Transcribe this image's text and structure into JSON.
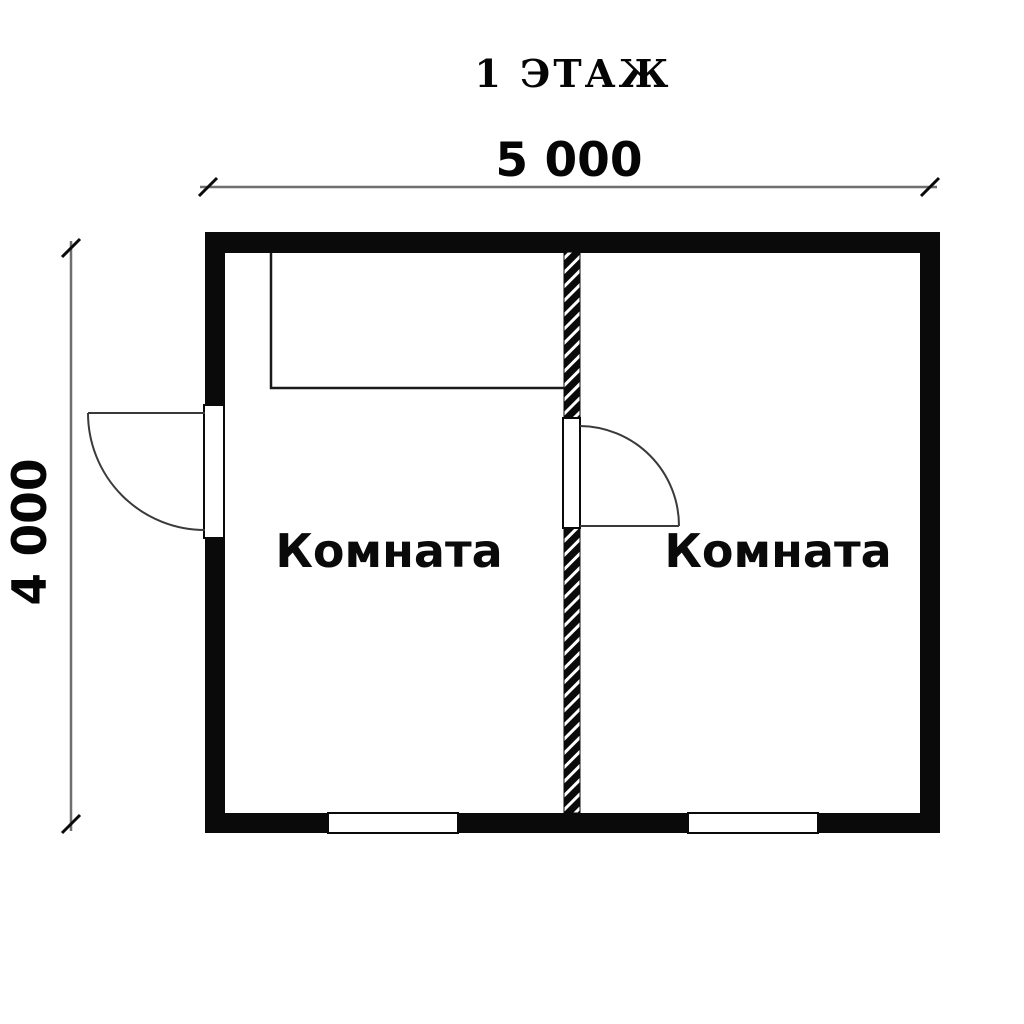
{
  "title": "1 ЭТАЖ",
  "dimensions": {
    "width_mm": "5 000",
    "height_mm": "4 000"
  },
  "rooms": [
    {
      "label": "Комната"
    },
    {
      "label": "Комната"
    }
  ],
  "colors": {
    "background": "#ffffff",
    "wall": "#0a0a0a",
    "dimension_line": "#6f6f6f",
    "text": "#050505"
  }
}
